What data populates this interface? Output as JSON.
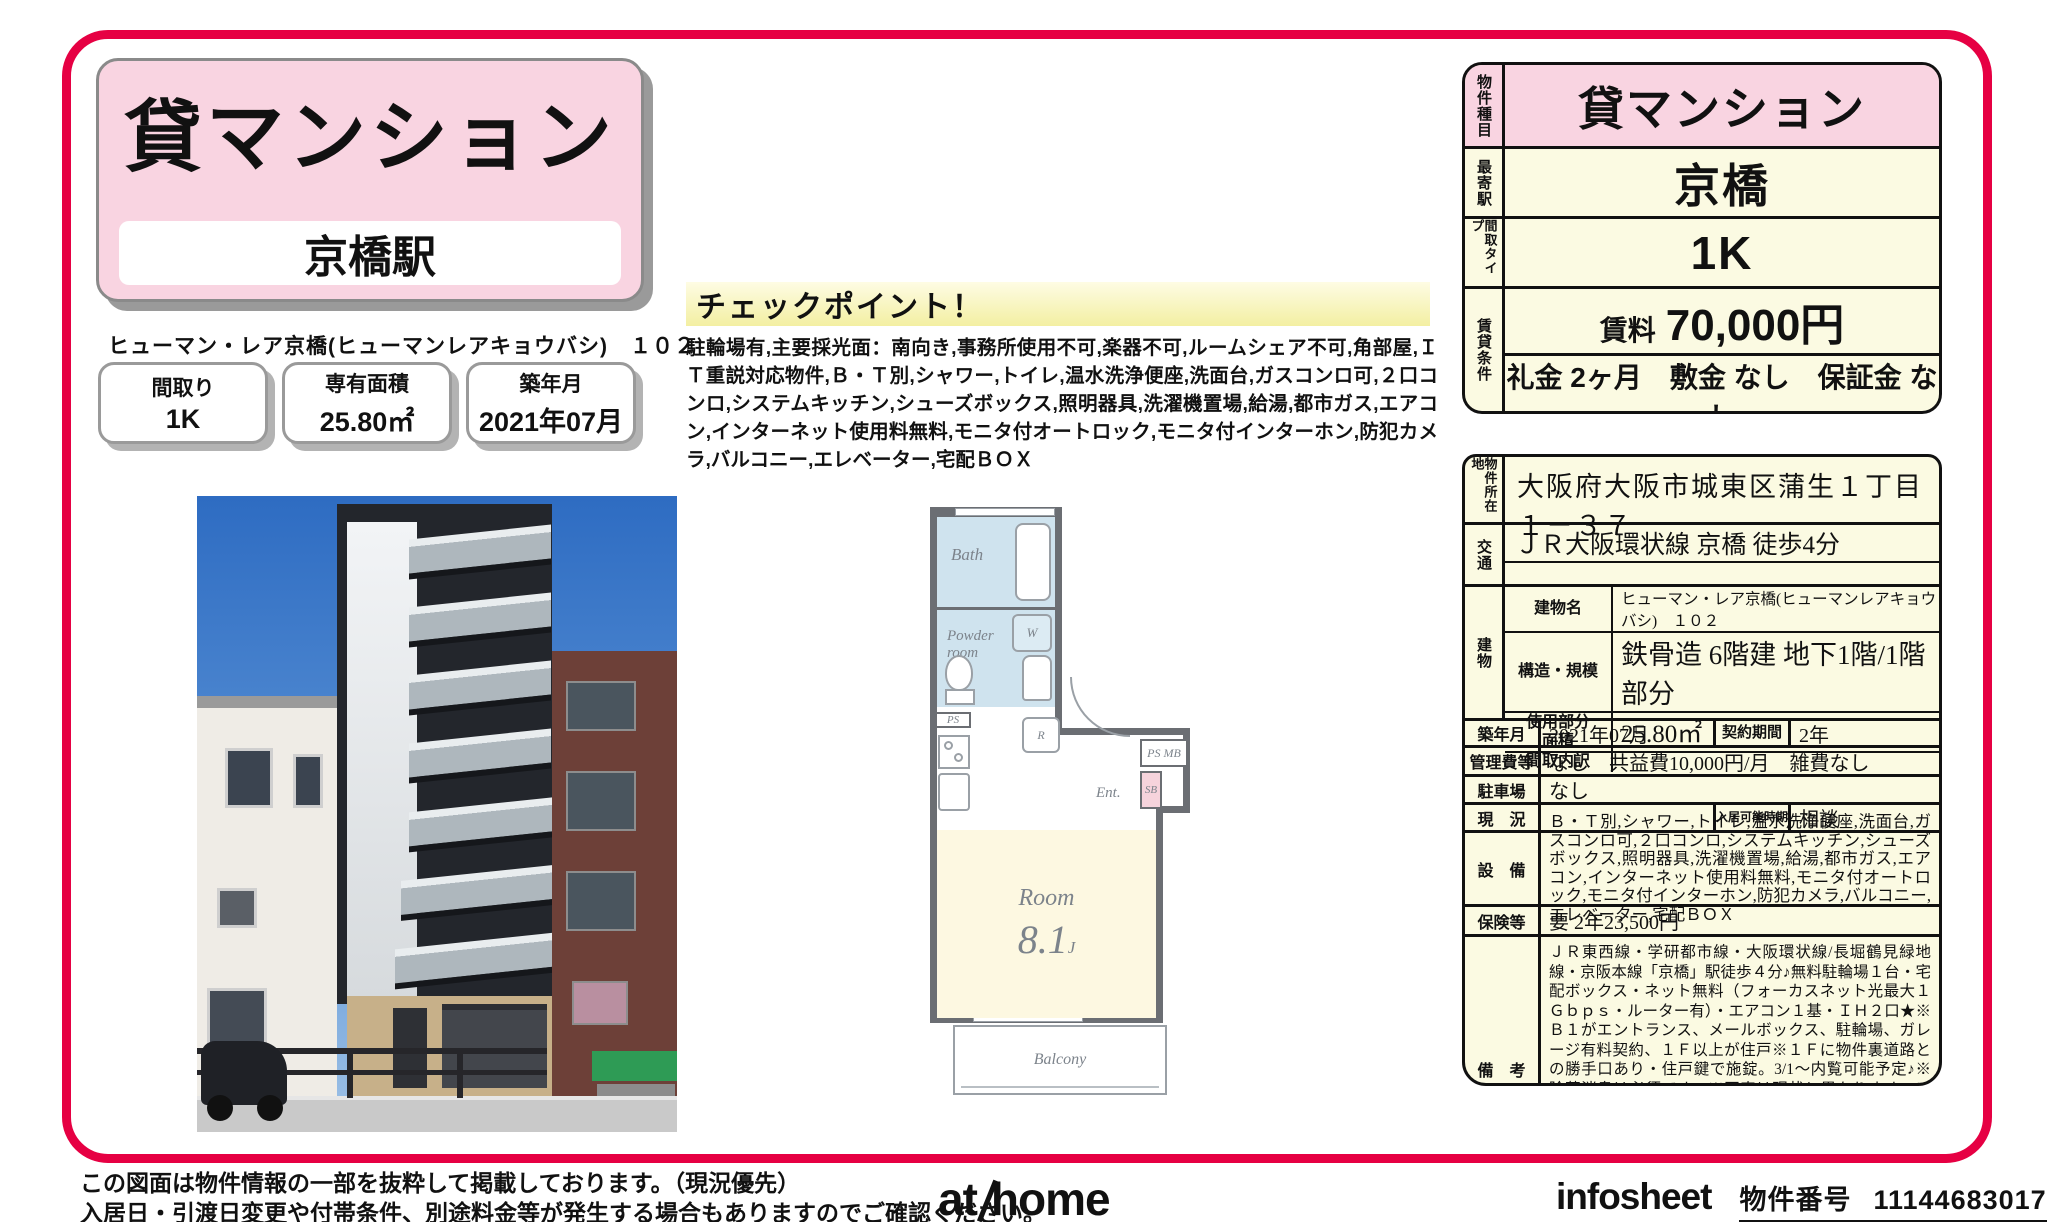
{
  "colors": {
    "frame_accent": "#e60043",
    "pink": "#f9d4e1",
    "cream": "#fbfae2",
    "plan_blue": "#cfe3ee",
    "plan_pink": "#f6d3dc"
  },
  "title": {
    "category": "貸マンション",
    "station": "京橋駅",
    "building_name": "ヒューマン・レア京橋(ヒューマンレアキョウバシ)　１０２"
  },
  "stats": [
    {
      "label": "間取り",
      "value": "1K"
    },
    {
      "label": "専有面積",
      "value": "25.80㎡"
    },
    {
      "label": "築年月",
      "value": "2021年07月"
    }
  ],
  "checkpoint": {
    "title": "チェックポイント！",
    "body": "駐輪場有,主要採光面：南向き,事務所使用不可,楽器不可,ルームシェア不可,角部屋,ＩＴ重説対応物件,Ｂ・Ｔ別,シャワー,トイレ,温水洗浄便座,洗面台,ガスコンロ可,２口コンロ,システムキッチン,シューズボックス,照明器具,洗濯機置場,給湯,都市ガス,エアコン,インターネット使用料無料,モニタ付オートロック,モニタ付インターホン,防犯カメラ,バルコニー,エレベーター,宅配ＢＯＸ"
  },
  "floorplan": {
    "bath": "Bath",
    "powder": "Powder room",
    "closet": "W",
    "ps": "PS",
    "fridge": "R",
    "entrance": "Ent.",
    "psmb": "PS MB",
    "shoebox": "SB",
    "room": "Room",
    "room_size": "8.1",
    "room_size_unit": "J",
    "balcony": "Balcony"
  },
  "summary": {
    "property_type_label": "物件種目",
    "property_type": "貸マンション",
    "station_label": "最寄駅",
    "station": "京橋",
    "layout_label": "間取タイプ",
    "layout": "1K",
    "terms_label": "賃貸条件",
    "rent_label": "賃料",
    "rent": "70,000円",
    "fees": "礼金 2ヶ月　敷金 なし　保証金 なし"
  },
  "details": {
    "address_label": "物件所在地",
    "address": "大阪府大阪市城東区蒲生１丁目 １－３７",
    "access_label": "交通",
    "access1": "ＪＲ大阪環状線 京橋 徒歩4分",
    "access2": "",
    "building_label": "建物",
    "building_name_label": "建物名",
    "building_name": "ヒューマン・レア京橋(ヒューマンレアキョウバシ)　１０２",
    "structure_label": "構造・規模",
    "structure": "鉄骨造 6階建 地下1階/1階部分",
    "area_label": "使用部分面積",
    "area": "25.80㎡",
    "layout_detail_label": "間取内訳",
    "layout_detail": "",
    "built_label": "築年月",
    "built": "2021年07月",
    "contract_label": "契約期間",
    "contract": "2年",
    "mgmt_label": "管理費等",
    "mgmt": "なし　共益費10,000円/月　雑費なし",
    "parking_label": "駐車場",
    "parking": "なし",
    "status_label": "現　況",
    "status": "",
    "movein_label": "入居可能時期",
    "movein": "相談",
    "equipment_label": "設　備",
    "equipment": "Ｂ・Ｔ別,シャワー,トイレ,温水洗浄便座,洗面台,ガスコンロ可,２口コンロ,システムキッチン,シューズボックス,照明器具,洗濯機置場,給湯,都市ガス,エアコン,インターネット使用料無料,モニタ付オートロック,モニタ付インターホン,防犯カメラ,バルコニー,エレベーター,宅配ＢＯＸ",
    "insurance_label": "保険等",
    "insurance": "要 2年23,500円",
    "notes_label": "備　考",
    "notes": "ＪＲ東西線・学研都市線・大阪環状線/長堀鶴見緑地線・京阪本線「京橋」駅徒歩４分♪無料駐輪場１台・宅配ボックス・ネット無料（フォーカスネット光最大１Ｇｂｐｓ・ルーター有）・エアコン１基・ＩＨ２口★※Ｂ１がエントランス、メールボックス、駐輪場、ガレージ有料契約、１Ｆ以上が住戸※１Ｆに物件裏道路との勝手口あり・住戸鍵で施錠。3/1～内覧可能予定♪※除菌消臭は必須です。※写真は現状と異なります。※洋室収納タンスは設備です。　室内除菌消臭費：11,000円　鍵交換代：22,000円　更新料：旧賃料１ヶ月　賃貸保証：加入要 クレディセゾン：初回総賃料５０％、毎月支払手数料総額１％　利用駅１：京阪電鉄本線 京橋 徒歩4分　利用駅２：ＪＲ片町線 京橋 徒歩4分"
  },
  "footer": {
    "disclaimer1": "この図面は物件情報の一部を抜粋して掲載しております。（現況優先）",
    "disclaimer2": "入居日・引渡日変更や付帯条件、別途料金等が発生する場合もありますのでご確認ください。",
    "logo_at": "at",
    "logo_home": "home",
    "infosheet": "infosheet",
    "property_no_label": "物件番号",
    "property_no": "11144683017"
  }
}
